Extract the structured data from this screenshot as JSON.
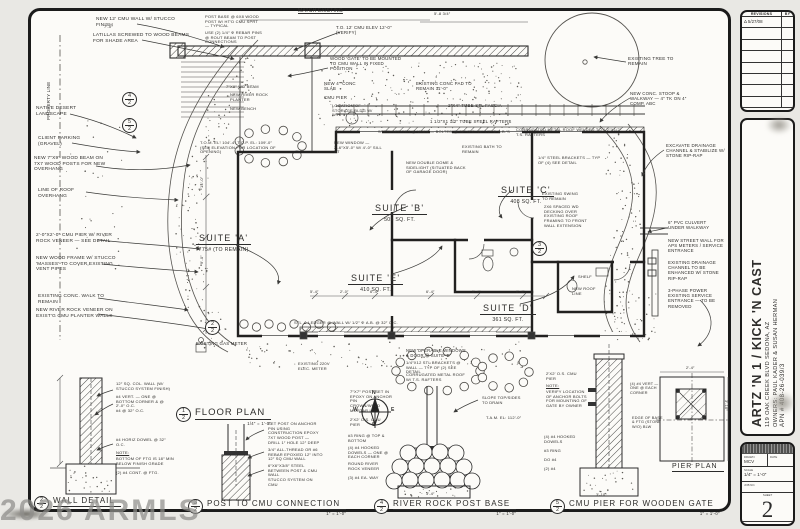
{
  "watermark": "2026 ARMLS",
  "title_block": {
    "revisions": {
      "title": "REVISIONS",
      "by": "BY",
      "rows": [
        "Δ 5/27/08",
        "",
        "",
        "",
        "",
        "",
        "",
        ""
      ]
    },
    "project": {
      "title": "ARTZ 'N 1 / KICK 'N CAST",
      "address": "119 OAK CREEK BLVD    SEDONA, AZ",
      "owners": "OWNERS: PAUL KADER & SUSAN HERMAN",
      "apn": "APN # 408-26-039/3"
    },
    "stamp": {
      "drawn_label": "DRAWN",
      "drawn_value": "MCV",
      "date_label": "DATE",
      "scale_label": "SCALE",
      "scale_value": "1/4″ = 1′-0″",
      "job_label": "JOB NO.",
      "sheet_label": "SHEET",
      "sheet_number": "2",
      "of_label": "OF",
      "sheets_label": "SHEETS"
    }
  },
  "compass": {
    "n": "N",
    "e": "E",
    "s": "S",
    "w": "W"
  },
  "plan": {
    "suites": [
      {
        "name": "SUITE 'A'",
        "area": "775# (TO REMAIN)",
        "x": 196,
        "y": 228
      },
      {
        "name": "SUITE 'B'",
        "area": "505 SQ. FT.",
        "x": 372,
        "y": 198
      },
      {
        "name": "SUITE 'C'",
        "area": "408 SQ. FT.",
        "x": 498,
        "y": 180
      },
      {
        "name": "SUITE 'E'",
        "area": "410 SQ. FT.",
        "x": 348,
        "y": 268
      },
      {
        "name": "SUITE 'D'",
        "area": "361 SQ. FT.",
        "x": 480,
        "y": 298
      }
    ]
  },
  "details": [
    {
      "num": "1",
      "sheet": "2",
      "title": "FLOOR PLAN",
      "scale": "1/4″ = 1′-0″",
      "x": 176,
      "y": 407,
      "big": 1
    },
    {
      "num": "2",
      "sheet": "2",
      "title": "WALL DETAIL",
      "scale": "1″ = 1′-0″",
      "x": 34,
      "y": 496
    },
    {
      "num": "3",
      "sheet": "2",
      "title": "POST TO CMU CONNECTION",
      "scale": "1″ = 1′-0″",
      "x": 188,
      "y": 499
    },
    {
      "num": "4",
      "sheet": "2",
      "title": "RIVER ROCK POST BASE",
      "scale": "1″ = 1′-0″",
      "x": 374,
      "y": 499
    },
    {
      "num": "5",
      "sheet": "2",
      "title": "CMU PIER FOR WOODEN GATE",
      "scale": "1″ = 1′-0″",
      "x": 550,
      "y": 499
    },
    {
      "title": "PIER PLAN",
      "x": 672,
      "y": 463,
      "plain": 1
    }
  ],
  "callouts": [
    {
      "n": "4",
      "s": "2",
      "x": 122,
      "y": 92
    },
    {
      "n": "5",
      "s": "2",
      "x": 122,
      "y": 118
    },
    {
      "n": "2",
      "s": "2",
      "x": 205,
      "y": 320
    },
    {
      "n": "3",
      "s": "2",
      "x": 532,
      "y": 241
    }
  ],
  "annotations": [
    {
      "t": "NEW 12′ CMU WALL W/ STUCCO FINISH",
      "x": 96,
      "y": 17,
      "w": 82
    },
    {
      "t": "LATILLAS SCREWED TO WOOD BEAMS FOR SHADE AREA",
      "x": 93,
      "y": 33,
      "w": 98
    },
    {
      "t": "POST BASE @ 6x8 WOOD POST W/ HT′D CMU SPRT — TYPICAL",
      "x": 205,
      "y": 15,
      "w": 58,
      "s": 4
    },
    {
      "t": "USE (2) 1/4″ φ REBAR PINS @ ROUT BEAM TO POST CONNECTIONS",
      "x": 205,
      "y": 31,
      "w": 60,
      "s": 4
    },
    {
      "t": "MATCH EXISTING",
      "x": 298,
      "y": 9,
      "w": 60,
      "s": 5,
      "u": 1
    },
    {
      "t": "5′-8 3/4″",
      "x": 434,
      "y": 12,
      "w": 30,
      "s": 4
    },
    {
      "t": "7′-0″",
      "x": 104,
      "y": 25,
      "w": 20,
      "s": 4
    },
    {
      "t": "T.O. 12′ CMU ELEV 12′-0″ (VERIFY)",
      "x": 336,
      "y": 25,
      "w": 56,
      "s": 4.4
    },
    {
      "t": "WOOD ′GATE′ TO BE MOUNTED TO CMU WALL IN FIXED POSITION",
      "x": 330,
      "y": 56,
      "w": 74,
      "s": 4.4
    },
    {
      "t": "NEW 4″ CONC SLAB",
      "x": 324,
      "y": 81,
      "w": 42,
      "s": 4.4
    },
    {
      "t": "CMU PIER",
      "x": 324,
      "y": 95,
      "w": 32,
      "s": 4.4
    },
    {
      "t": "EXISTING CONC PAD TO REMAIN  11′-0″",
      "x": 416,
      "y": 81,
      "w": 62,
      "s": 4.4
    },
    {
      "t": "2″x4″ TUBE STL FASCIA",
      "x": 448,
      "y": 103,
      "w": 72,
      "s": 4.4
    },
    {
      "t": "1 1/2″x1 1/2″ TUBE STEEL RAFTERS",
      "x": 430,
      "y": 119,
      "w": 92,
      "s": 4.4
    },
    {
      "t": "STEEL LEDGER @ WALL — BOLTED @ 32″ O.C. W/ 1/2″ φ A.B.′S",
      "x": 378,
      "y": 130,
      "w": 135,
      "s": 4
    },
    {
      "t": "EXISTING TREE TO REMAIN",
      "x": 628,
      "y": 56,
      "w": 48,
      "s": 4.6
    },
    {
      "t": "NEW CONC. STOOP & WALKWAY — 4″ TK ON 4″ COMP. ABC",
      "x": 630,
      "y": 91,
      "w": 58,
      "s": 4.4
    },
    {
      "t": "PROPERTY LINE",
      "x": 46,
      "y": 120,
      "w": 60,
      "s": 4.5,
      "r": -90
    },
    {
      "t": "NATIVE DESERT LANDSCAPE",
      "x": 36,
      "y": 106,
      "w": 46
    },
    {
      "t": "CLIENT PARKING (GRAVEL)",
      "x": 38,
      "y": 136,
      "w": 44
    },
    {
      "t": "NEW 7″x9″ WOOD BEAM ON 7x7 WOOD POSTS FOR NEW OVERHANG",
      "x": 34,
      "y": 156,
      "w": 78
    },
    {
      "t": "LINE OF ROOF OVERHANG",
      "x": 38,
      "y": 188,
      "w": 62
    },
    {
      "t": "2′-0″x2′-0″ CMU PIER W/ RIVER ROCK VENEER — SEE DETAIL",
      "x": 36,
      "y": 233,
      "w": 82
    },
    {
      "t": "NEW WOOD FRAME W/ STUCCO ′MASSES′ TO COVER EXISTING VENT PIPES",
      "x": 36,
      "y": 256,
      "w": 86
    },
    {
      "t": "EXISTING CONC. WALK TO REMAIN",
      "x": 38,
      "y": 294,
      "w": 82
    },
    {
      "t": "NEW RIVER ROCK VENEER ON EXIST′G CMU PLANTER WALLS",
      "x": 36,
      "y": 308,
      "w": 84
    },
    {
      "t": "T.O.M. EL: 104′-4″  T.O.P. EL: 109′-0″ (SEE ELEVATION FOR LOCATION OF OPENING)",
      "x": 200,
      "y": 141,
      "w": 80,
      "s": 4
    },
    {
      "t": "7″x9″ WD BEAM",
      "x": 226,
      "y": 85,
      "w": 42,
      "s": 4
    },
    {
      "t": "NEW RIVER ROCK PLANTER",
      "x": 230,
      "y": 93,
      "w": 44,
      "s": 4
    },
    {
      "t": "NEW BENCH",
      "x": 230,
      "y": 107,
      "w": 32,
      "s": 4
    },
    {
      "t": "LOCATION OF STORAGE BLDG W/ W.H.",
      "x": 332,
      "y": 104,
      "w": 50,
      "s": 4
    },
    {
      "t": "NEW WINDOW — 2′-6″x5′-0″ W/ 4′-0″ SILL HT",
      "x": 334,
      "y": 141,
      "w": 52,
      "s": 4
    },
    {
      "t": "NEW DOUBLE DOME & SIDELIGHT (SITUATED BACK OF GARAGE DOOR)",
      "x": 406,
      "y": 161,
      "w": 62,
      "s": 4
    },
    {
      "t": "EXISTING BATH TO REMAIN",
      "x": 462,
      "y": 145,
      "w": 40,
      "s": 4
    },
    {
      "t": "CORRUGATED METAL ROOF WELDED TO 1/2″x1/2″ T.S. RAFTERS",
      "x": 516,
      "y": 128,
      "w": 110,
      "s": 4
    },
    {
      "t": "1/4″ STEEL BRACKETS — TYP OF (4) SEE DETAIL",
      "x": 538,
      "y": 156,
      "w": 68,
      "s": 4
    },
    {
      "t": "EXISTING SWING TO REMAIN",
      "x": 542,
      "y": 192,
      "w": 42,
      "s": 4
    },
    {
      "t": "2x6 SPACED WD DECKING OVER EXISTING ROOF FRAMING TO FRONT WALL EXTENSION",
      "x": 544,
      "y": 205,
      "w": 48,
      "s": 4
    },
    {
      "t": "EXCAVATE DRAINAGE CHANNEL & STABILIZE W/ STONE RIP-RAP",
      "x": 666,
      "y": 143,
      "w": 62,
      "s": 4.4
    },
    {
      "t": "6″ PVC CULVERT UNDER WALKWAY",
      "x": 668,
      "y": 220,
      "w": 56,
      "s": 4.4
    },
    {
      "t": "NEW STREET WALL FOR APS METERS / SERVICE ENTRANCE",
      "x": 668,
      "y": 238,
      "w": 60,
      "s": 4.4
    },
    {
      "t": "EXISTING DRAINAGE CHANNEL TO BE ENHANCED W/ STONE RIP-RAP",
      "x": 668,
      "y": 260,
      "w": 60,
      "s": 4.4
    },
    {
      "t": "3-PHASE POWER EXISTING SERVICE ENTRANCE — TO BE REMOVED",
      "x": 668,
      "y": 288,
      "w": 56,
      "s": 4.4
    },
    {
      "t": "SHELF",
      "x": 578,
      "y": 275,
      "w": 20,
      "s": 4
    },
    {
      "t": "NEW ROOF LINE",
      "x": 572,
      "y": 287,
      "w": 30,
      "s": 4
    },
    {
      "t": "EXISTING GAS METER",
      "x": 196,
      "y": 341,
      "w": 62,
      "s": 4.4
    },
    {
      "t": "EXISTING 220V ELEC. METER",
      "x": 298,
      "y": 362,
      "w": 42,
      "s": 4
    },
    {
      "t": "STL ∠ LEDGER @ WALL W/ 1/2″ φ A.B. @ 32″ O.C.",
      "x": 294,
      "y": 321,
      "w": 132,
      "s": 4
    },
    {
      "t": "NEW OPERABLE WINDOWS & DOOR @ SUITE ′D′",
      "x": 406,
      "y": 349,
      "w": 64,
      "s": 4.2
    },
    {
      "t": "1/4″x12 STL BRACKETS @ WALL — TYP OF (2) SEE DETAIL",
      "x": 406,
      "y": 361,
      "w": 66,
      "s": 4
    },
    {
      "t": "CORRUGATED METAL ROOF W/ T.S. RAFTERS",
      "x": 406,
      "y": 373,
      "w": 60,
      "s": 4
    },
    {
      "t": "14′-0″",
      "x": 200,
      "y": 188,
      "w": 24,
      "s": 4,
      "r": -90
    },
    {
      "t": "9′-0″",
      "x": 200,
      "y": 264,
      "w": 22,
      "s": 4,
      "r": -90
    },
    {
      "t": "5′-4″",
      "x": 310,
      "y": 290,
      "w": 18,
      "s": 3.8
    },
    {
      "t": "2′-0″",
      "x": 340,
      "y": 290,
      "w": 18,
      "s": 3.8
    },
    {
      "t": "6′-4″",
      "x": 370,
      "y": 290,
      "w": 18,
      "s": 3.8
    },
    {
      "t": "6′-4″",
      "x": 426,
      "y": 290,
      "w": 18,
      "s": 3.8
    },
    {
      "t": "5′-4″",
      "x": 472,
      "y": 290,
      "w": 18,
      "s": 3.8
    },
    {
      "t": "6′-4″",
      "x": 516,
      "y": 290,
      "w": 18,
      "s": 3.8
    },
    {
      "t": "12″ SQ. COL. WALL (W/ STUCCO SYSTEM FINISH)",
      "x": 116,
      "y": 382,
      "w": 58,
      "s": 4
    },
    {
      "t": "#4 VERT. — ONE @ BOTTOM CORNER & @ 2′-0″ O.C.",
      "x": 116,
      "y": 395,
      "w": 58,
      "s": 4
    },
    {
      "t": "#4 @ 32″ O.C.",
      "x": 116,
      "y": 409,
      "w": 38,
      "s": 4
    },
    {
      "t": "#4 HORIZ DOWEL @ 32″ O.C.",
      "x": 116,
      "y": 438,
      "w": 56,
      "s": 4
    },
    {
      "t": "NOTE:",
      "x": 116,
      "y": 451,
      "w": 22,
      "s": 4,
      "u": 1
    },
    {
      "t": "BOTTOM OF FTG IS 18″ MIN BELOW FINISH GRADE",
      "x": 116,
      "y": 457,
      "w": 58,
      "s": 4
    },
    {
      "t": "(2) #4 CONT. @ FTG.",
      "x": 116,
      "y": 471,
      "w": 50,
      "s": 4
    },
    {
      "t": "SET POST ON ANCHOR PIN USING CONSTRUCTION EPOXY",
      "x": 268,
      "y": 422,
      "w": 56,
      "s": 4
    },
    {
      "t": "7x7 WOOD POST — DRILL 1″ HOLE 12″ DEEP",
      "x": 268,
      "y": 436,
      "w": 54,
      "s": 4
    },
    {
      "t": "3/4″ ALL-THREAD OR #6 REBAR EPOXIED 12″ INTO 12″ SQ CMU WALL",
      "x": 268,
      "y": 448,
      "w": 56,
      "s": 4
    },
    {
      "t": "6″x6″x3/8″ STEEL BETWEEN POST & CMU WALL",
      "x": 268,
      "y": 464,
      "w": 54,
      "s": 4
    },
    {
      "t": "STUCCO SYSTEM ON CMU",
      "x": 268,
      "y": 478,
      "w": 52,
      "s": 4
    },
    {
      "t": "7″x7″ POST SET IN EPOXY ON ANCHOR PIN",
      "x": 350,
      "y": 390,
      "w": 48,
      "s": 4
    },
    {
      "t": "CROWN/WELD MORTAR LOW",
      "x": 350,
      "y": 404,
      "w": 40,
      "s": 4
    },
    {
      "t": "2′x2′ O.S. CMU PIER",
      "x": 350,
      "y": 418,
      "w": 38,
      "s": 4
    },
    {
      "t": "#3 RING @ TOP & BOTTOM",
      "x": 348,
      "y": 434,
      "w": 44,
      "s": 4
    },
    {
      "t": "(4) #4 HOOKED DOWELS — ONE @ EACH CORNER",
      "x": 348,
      "y": 446,
      "w": 48,
      "s": 4
    },
    {
      "t": "ROUND RIVER ROCK VENEER",
      "x": 348,
      "y": 462,
      "w": 42,
      "s": 4
    },
    {
      "t": "(3) #4 EA. WAY",
      "x": 348,
      "y": 476,
      "w": 38,
      "s": 4
    },
    {
      "t": "SLOPE TOP/SIDES TO DRAIN",
      "x": 482,
      "y": 396,
      "w": 40,
      "s": 4
    },
    {
      "t": "T.A.M. EL: 112′-0″",
      "x": 486,
      "y": 416,
      "w": 36,
      "s": 4
    },
    {
      "t": "3′-4″",
      "x": 426,
      "y": 492,
      "w": 20,
      "s": 3.8
    },
    {
      "t": "2′x2′ O.S. CMU PIER",
      "x": 546,
      "y": 372,
      "w": 40,
      "s": 4
    },
    {
      "t": "NOTE:",
      "x": 546,
      "y": 384,
      "w": 22,
      "s": 4,
      "u": 1
    },
    {
      "t": "VERIFY LOCATION OF ANCHOR BOLTS FOR MOUNTING OF GATE BY OWNER",
      "x": 546,
      "y": 390,
      "w": 42,
      "s": 4
    },
    {
      "t": "(4) #4 HOOKED DOWELS",
      "x": 544,
      "y": 435,
      "w": 40,
      "s": 4
    },
    {
      "t": "#3 RING",
      "x": 544,
      "y": 449,
      "w": 30,
      "s": 4
    },
    {
      "t": "DO #4",
      "x": 544,
      "y": 458,
      "w": 24,
      "s": 4
    },
    {
      "t": "(2) #4",
      "x": 544,
      "y": 467,
      "w": 24,
      "s": 4
    },
    {
      "t": "3′-10″",
      "x": 596,
      "y": 493,
      "w": 22,
      "s": 3.8
    },
    {
      "t": "(4) #4 VERT — ONE @ EACH CORNER",
      "x": 630,
      "y": 382,
      "w": 34,
      "s": 3.8
    },
    {
      "t": "EDGE OF BASE & FTG (STONE W/O) BLW",
      "x": 632,
      "y": 416,
      "w": 34,
      "s": 3.8
    },
    {
      "t": "2′-4″",
      "x": 686,
      "y": 366,
      "w": 20,
      "s": 3.8
    },
    {
      "t": "3′-10″",
      "x": 728,
      "y": 400,
      "w": 22,
      "s": 3.8,
      "r": 90
    }
  ]
}
